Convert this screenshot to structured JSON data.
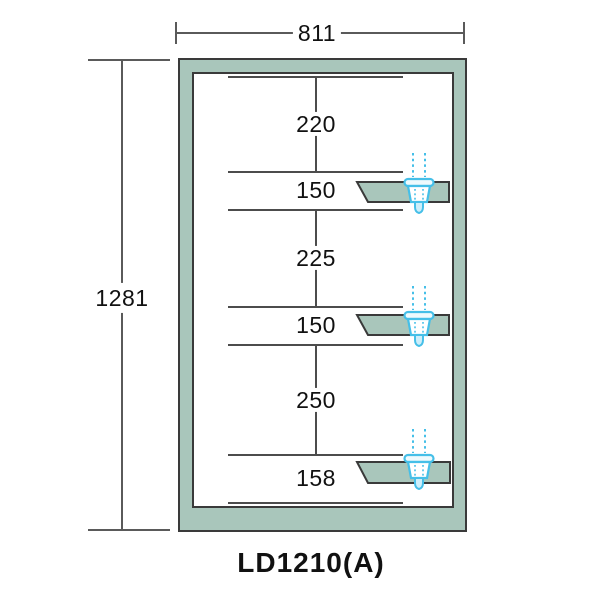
{
  "product": {
    "model_label": "LD1210(A)"
  },
  "dimensions": {
    "overall_width": "811",
    "overall_height": "1281",
    "sections": [
      "220",
      "150",
      "225",
      "150",
      "250",
      "158"
    ]
  },
  "colors": {
    "frame-fill": "#a9c6bb",
    "frame-border": "#3a3a3a",
    "dim-line": "#5a5a5a",
    "inner-line": "#4c4c4c",
    "sprinkler": "#45bfe8",
    "text": "#111111"
  },
  "icons": {
    "sprinkler": "sprinkler-nozzle-icon"
  }
}
